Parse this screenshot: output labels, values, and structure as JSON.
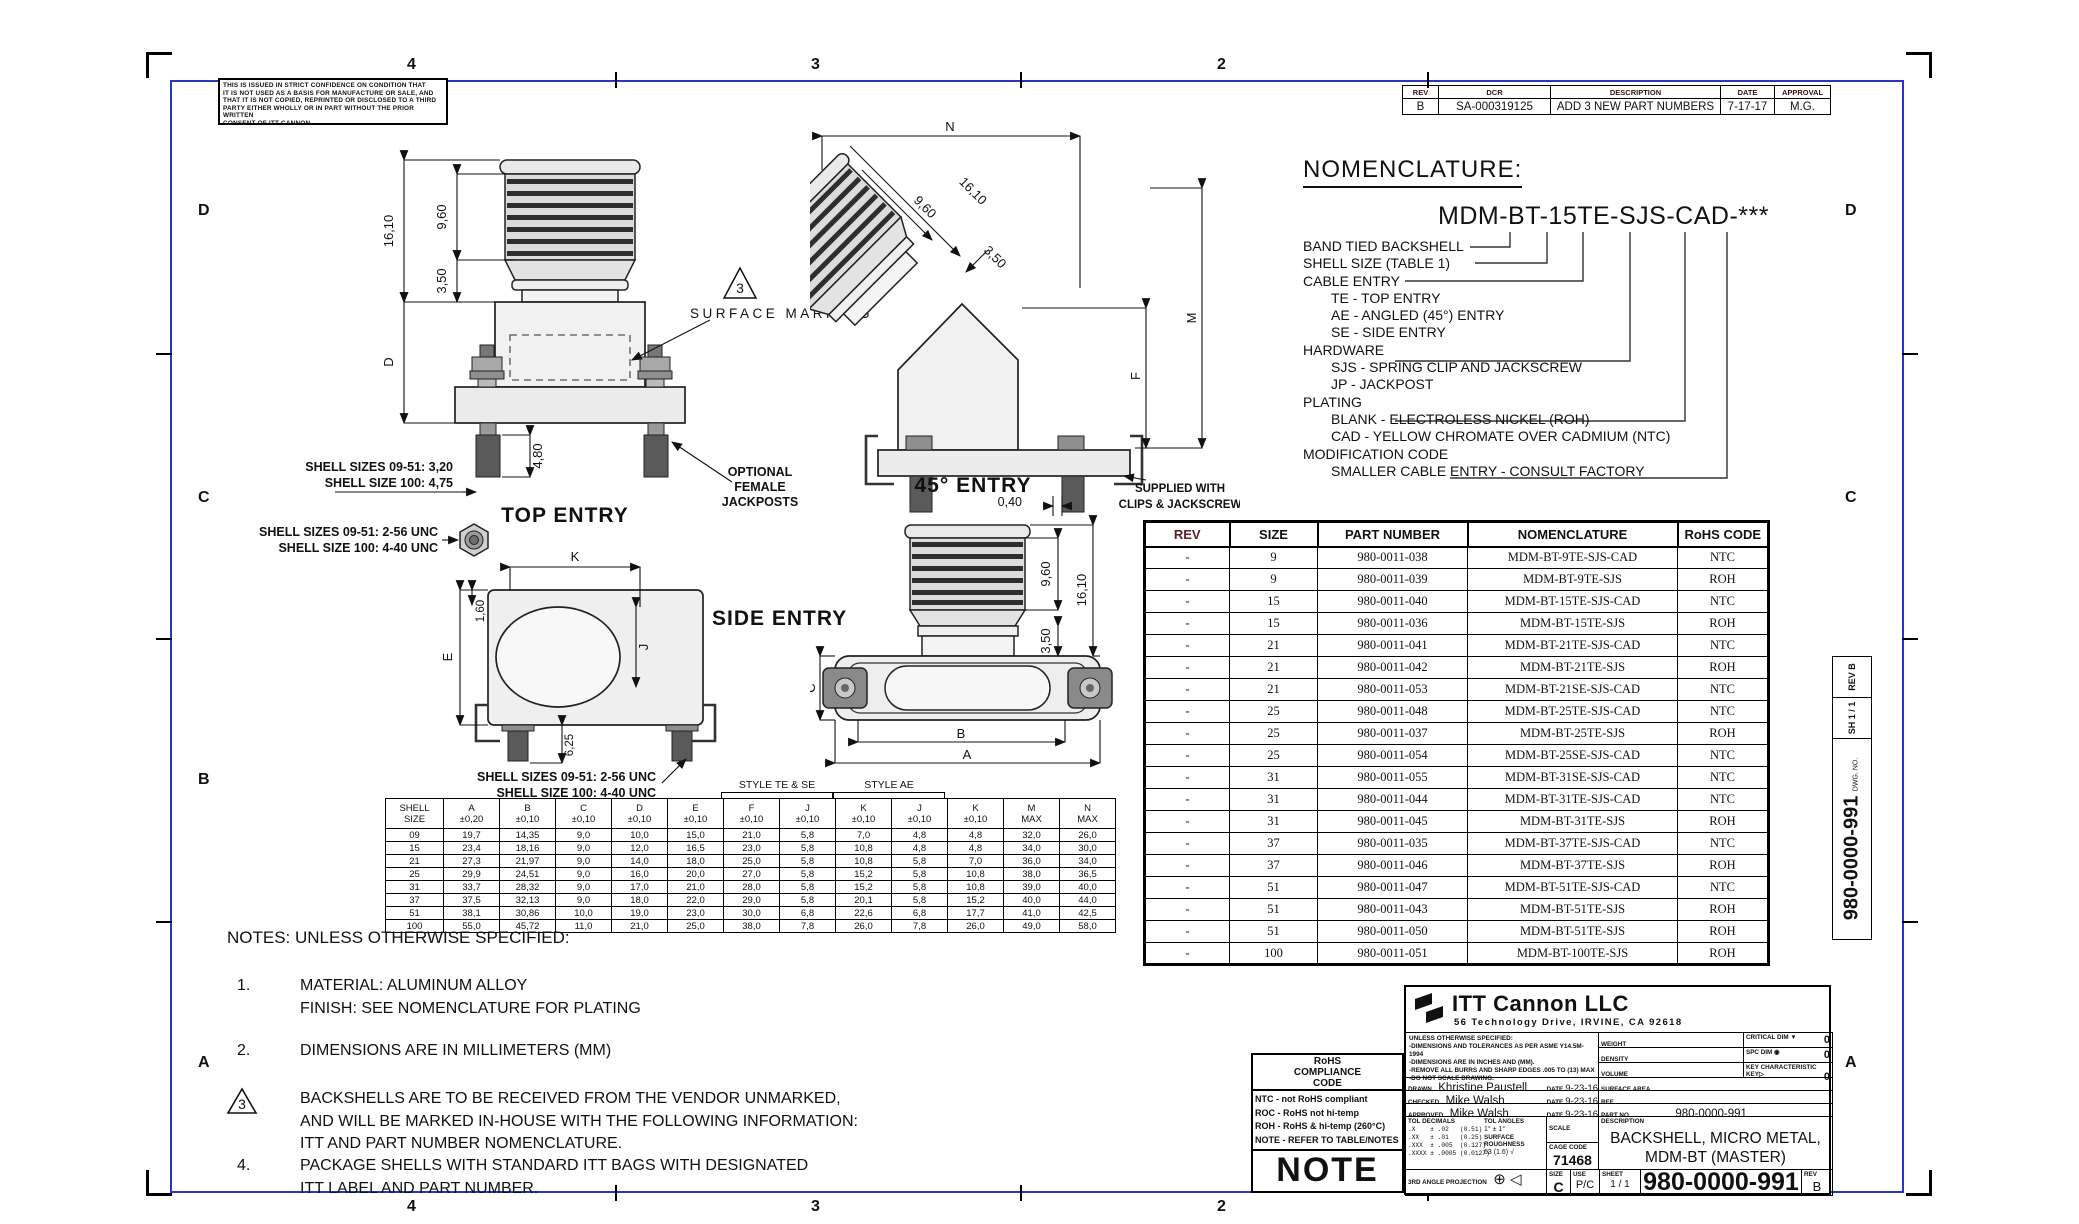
{
  "sheet": {
    "zones_top": [
      "4",
      "3",
      "2"
    ],
    "zones_bottom": [
      "4",
      "3",
      "2"
    ],
    "zones_left": [
      "D",
      "C",
      "B",
      "A"
    ],
    "zones_right": [
      "D",
      "C",
      "A"
    ],
    "confidence_notice": "THIS IS ISSUED IN STRICT CONFIDENCE ON CONDITION THAT\nIT IS NOT USED AS A BASIS FOR MANUFACTURE OR SALE, AND\nTHAT IT IS NOT COPIED, REPRINTED OR DISCLOSED TO A THIRD\nPARTY EITHER WHOLLY OR IN PART WITHOUT THE PRIOR WRITTEN\nCONSENT OF ITT CANNON."
  },
  "revision_table": {
    "headers": [
      "REV",
      "DCR",
      "DESCRIPTION",
      "DATE",
      "APPROVAL"
    ],
    "rows": [
      [
        "B",
        "SA-000319125",
        "ADD 3 NEW PART NUMBERS",
        "7-17-17",
        "M.G."
      ]
    ]
  },
  "nomenclature": {
    "title": "NOMENCLATURE:",
    "part_code": "MDM-BT-15TE-SJS-CAD-***",
    "lines": [
      {
        "indent": 0,
        "text": "BAND TIED BACKSHELL"
      },
      {
        "indent": 0,
        "text": "SHELL SIZE (TABLE 1)"
      },
      {
        "indent": 0,
        "text": "CABLE ENTRY"
      },
      {
        "indent": 1,
        "text": "TE - TOP ENTRY"
      },
      {
        "indent": 1,
        "text": "AE - ANGLED (45°) ENTRY"
      },
      {
        "indent": 1,
        "text": "SE - SIDE ENTRY"
      },
      {
        "indent": 0,
        "text": "HARDWARE"
      },
      {
        "indent": 1,
        "text": "SJS - SPRING CLIP AND JACKSCREW"
      },
      {
        "indent": 1,
        "text": "JP - JACKPOST"
      },
      {
        "indent": 0,
        "text": "PLATING"
      },
      {
        "indent": 1,
        "text": "BLANK - ELECTROLESS NICKEL (ROH)"
      },
      {
        "indent": 1,
        "text": "CAD - YELLOW CHROMATE OVER CADMIUM (NTC)"
      },
      {
        "indent": 0,
        "text": "MODIFICATION CODE"
      },
      {
        "indent": 1,
        "text": "SMALLER CABLE ENTRY - CONSULT FACTORY"
      }
    ]
  },
  "parts_table": {
    "headers": [
      "REV",
      "SIZE",
      "PART NUMBER",
      "NOMENCLATURE",
      "RoHS CODE"
    ],
    "rows": [
      [
        "-",
        "9",
        "980-0011-038",
        "MDM-BT-9TE-SJS-CAD",
        "NTC"
      ],
      [
        "-",
        "9",
        "980-0011-039",
        "MDM-BT-9TE-SJS",
        "ROH"
      ],
      [
        "-",
        "15",
        "980-0011-040",
        "MDM-BT-15TE-SJS-CAD",
        "NTC"
      ],
      [
        "-",
        "15",
        "980-0011-036",
        "MDM-BT-15TE-SJS",
        "ROH"
      ],
      [
        "-",
        "21",
        "980-0011-041",
        "MDM-BT-21TE-SJS-CAD",
        "NTC"
      ],
      [
        "-",
        "21",
        "980-0011-042",
        "MDM-BT-21TE-SJS",
        "ROH"
      ],
      [
        "-",
        "21",
        "980-0011-053",
        "MDM-BT-21SE-SJS-CAD",
        "NTC"
      ],
      [
        "-",
        "25",
        "980-0011-048",
        "MDM-BT-25TE-SJS-CAD",
        "NTC"
      ],
      [
        "-",
        "25",
        "980-0011-037",
        "MDM-BT-25TE-SJS",
        "ROH"
      ],
      [
        "-",
        "25",
        "980-0011-054",
        "MDM-BT-25SE-SJS-CAD",
        "NTC"
      ],
      [
        "-",
        "31",
        "980-0011-055",
        "MDM-BT-31SE-SJS-CAD",
        "NTC"
      ],
      [
        "-",
        "31",
        "980-0011-044",
        "MDM-BT-31TE-SJS-CAD",
        "NTC"
      ],
      [
        "-",
        "31",
        "980-0011-045",
        "MDM-BT-31TE-SJS",
        "ROH"
      ],
      [
        "-",
        "37",
        "980-0011-035",
        "MDM-BT-37TE-SJS-CAD",
        "NTC"
      ],
      [
        "-",
        "37",
        "980-0011-046",
        "MDM-BT-37TE-SJS",
        "ROH"
      ],
      [
        "-",
        "51",
        "980-0011-047",
        "MDM-BT-51TE-SJS-CAD",
        "NTC"
      ],
      [
        "-",
        "51",
        "980-0011-043",
        "MDM-BT-51TE-SJS",
        "ROH"
      ],
      [
        "-",
        "51",
        "980-0011-050",
        "MDM-BT-51TE-SJS",
        "ROH"
      ],
      [
        "-",
        "100",
        "980-0011-051",
        "MDM-BT-100TE-SJS",
        "ROH"
      ]
    ]
  },
  "dim_table": {
    "group_headers": [
      "STYLE TE & SE",
      "STYLE AE"
    ],
    "columns": [
      {
        "label": "SHELL",
        "sub": "SIZE"
      },
      {
        "label": "A",
        "sub": "±0,20"
      },
      {
        "label": "B",
        "sub": "±0,10"
      },
      {
        "label": "C",
        "sub": "±0,10"
      },
      {
        "label": "D",
        "sub": "±0,10"
      },
      {
        "label": "E",
        "sub": "±0,10"
      },
      {
        "label": "F",
        "sub": "±0,10"
      },
      {
        "label": "J",
        "sub": "±0,10"
      },
      {
        "label": "K",
        "sub": "±0,10"
      },
      {
        "label": "J",
        "sub": "±0,10"
      },
      {
        "label": "K",
        "sub": "±0,10"
      },
      {
        "label": "M",
        "sub": "MAX"
      },
      {
        "label": "N",
        "sub": "MAX"
      }
    ],
    "rows": [
      [
        "09",
        "19,7",
        "14,35",
        "9,0",
        "10,0",
        "15,0",
        "21,0",
        "5,8",
        "7,0",
        "4,8",
        "4,8",
        "32,0",
        "26,0"
      ],
      [
        "15",
        "23,4",
        "18,16",
        "9,0",
        "12,0",
        "16,5",
        "23,0",
        "5,8",
        "10,8",
        "4,8",
        "4,8",
        "34,0",
        "30,0"
      ],
      [
        "21",
        "27,3",
        "21,97",
        "9,0",
        "14,0",
        "18,0",
        "25,0",
        "5,8",
        "10,8",
        "5,8",
        "7,0",
        "36,0",
        "34,0"
      ],
      [
        "25",
        "29,9",
        "24,51",
        "9,0",
        "16,0",
        "20,0",
        "27,0",
        "5,8",
        "15,2",
        "5,8",
        "10,8",
        "38,0",
        "36,5"
      ],
      [
        "31",
        "33,7",
        "28,32",
        "9,0",
        "17,0",
        "21,0",
        "28,0",
        "5,8",
        "15,2",
        "5,8",
        "10,8",
        "39,0",
        "40,0"
      ],
      [
        "37",
        "37,5",
        "32,13",
        "9,0",
        "18,0",
        "22,0",
        "29,0",
        "5,8",
        "20,1",
        "5,8",
        "15,2",
        "40,0",
        "44,0"
      ],
      [
        "51",
        "38,1",
        "30,86",
        "10,0",
        "19,0",
        "23,0",
        "30,0",
        "6,8",
        "22,6",
        "6,8",
        "17,7",
        "41,0",
        "42,5"
      ],
      [
        "100",
        "55,0",
        "45,72",
        "11,0",
        "21,0",
        "25,0",
        "38,0",
        "7,8",
        "26,0",
        "7,8",
        "26,0",
        "49,0",
        "58,0"
      ]
    ]
  },
  "notes": {
    "heading": "NOTES: UNLESS OTHERWISE SPECIFIED:",
    "items": [
      {
        "num": "1.",
        "lines": [
          "MATERIAL: ALUMINUM ALLOY",
          "FINISH: SEE NOMENCLATURE FOR PLATING"
        ]
      },
      {
        "num": "2.",
        "lines": [
          "DIMENSIONS ARE IN MILLIMETERS (MM)"
        ]
      },
      {
        "num": "3.",
        "flag_num": "3",
        "lines": [
          "BACKSHELLS ARE TO BE RECEIVED FROM THE VENDOR UNMARKED,",
          "AND WILL BE MARKED IN-HOUSE WITH THE FOLLOWING INFORMATION:",
          "ITT AND PART NUMBER NOMENCLATURE."
        ]
      },
      {
        "num": "4.",
        "lines": [
          "PACKAGE SHELLS WITH STANDARD ITT BAGS WITH DESIGNATED",
          "ITT LABEL AND PART NUMBER."
        ]
      }
    ]
  },
  "views": {
    "top_entry": {
      "label": "TOP ENTRY",
      "dim_overall": "16,10",
      "dim_ribs": "9,60",
      "dim_neck": "3,50",
      "dim_body": "D",
      "dim_stud": "4,80",
      "flag": "3",
      "surface_marking": "SURFACE MARKING",
      "jackposts_note_1": "OPTIONAL",
      "jackposts_note_2": "FEMALE",
      "jackposts_note_3": "JACKPOSTS",
      "stud_note_1": "SHELL SIZES 09-51: 3,20",
      "stud_note_2": "SHELL SIZE 100: 4,75",
      "thread_note_1": "SHELL SIZES 09-51: 2-56 UNC",
      "thread_note_2": "SHELL SIZE 100: 4-40 UNC"
    },
    "entry_45": {
      "label": "45° ENTRY",
      "dim_n": "N",
      "dim_ribs": "9,60",
      "dim_overall": "16,10",
      "dim_neck": "3,50",
      "dim_m": "M",
      "dim_f": "F",
      "clip_note_1": "SUPPLIED WITH",
      "clip_note_2": "CLIPS & JACKSCREW"
    },
    "side_entry": {
      "label": "SIDE ENTRY",
      "dim_k": "K",
      "dim_j": "J",
      "dim_e": "E",
      "dim_lip": "1,60",
      "dim_depth": "6,25",
      "thread_note_1": "SHELL SIZES 09-51: 2-56 UNC",
      "thread_note_2": "SHELL SIZE 100: 4-40 UNC"
    },
    "style_view": {
      "dim_gap": "0,40",
      "dim_ribs": "9,60",
      "dim_overall": "16,10",
      "dim_neck": "3,50",
      "dim_c": "C",
      "dim_b": "B",
      "dim_a": "A"
    }
  },
  "rohs_box": {
    "title": "RoHS\nCOMPLIANCE\nCODE",
    "legend": [
      "NTC - not RoHS compliant",
      "ROC - RoHS not hi-temp",
      "ROH - RoHS & hi-temp (260°C)",
      "NOTE - REFER TO TABLE/NOTES"
    ],
    "big_label": "NOTE"
  },
  "title_block": {
    "company": "ITT Cannon LLC",
    "address": "56 Technology Drive, IRVINE, CA 92618",
    "specs": "UNLESS OTHERWISE SPECIFIED:\n-DIMENSIONS AND TOLERANCES AS PER ASME Y14.5M-1994\n-DIMENSIONS ARE IN INCHES AND (MM).\n-REMOVE ALL BURRS AND SHARP EDGES .005 TO (13) MAX\n-DO NOT SCALE DRAWING.",
    "weight_label": "WEIGHT",
    "density_label": "DENSITY",
    "volume_label": "VOLUME",
    "surface_area_label": "SURFACE AREA",
    "ref_label": "REF",
    "quality": [
      {
        "label": "CRITICAL DIM",
        "symbol": "▼",
        "value": "0"
      },
      {
        "label": "SPC DIM",
        "symbol": "◉",
        "value": "0"
      },
      {
        "label": "KEY CHARACTERISTIC",
        "symbol": "KEY▷",
        "value": "0"
      }
    ],
    "drawn_label": "DRAWN",
    "drawn": "Khristine Paustell",
    "checked_label": "CHECKED",
    "checked": "Mike Walsh",
    "approved_label": "APPROVED",
    "approved": "Mike Walsh",
    "date_label": "DATE",
    "drawn_date": "9-23-16",
    "checked_date": "9-23-16",
    "approved_date": "9-23-16",
    "part_no_label": "PART NO",
    "part_no": "980-0000-991",
    "tol_title": "TOL DECIMALS",
    "tol_lines": ".X    ± .02   (0.51)\n.XX   ± .01   (0.25)\n.XXX  ± .005  (0.127)\n.XXXX ± .0005 (0.0127)",
    "tol_angles_title": "TOL ANGLES",
    "tol_angles": "1° ± 1°",
    "surface_roughness_label": "SURFACE ROUGHNESS",
    "surface_roughness": "63 (1.6) √",
    "scale_label": "SCALE",
    "cage_label": "CAGE CODE",
    "cage_code": "71468",
    "description_label": "DESCRIPTION",
    "description": "BACKSHELL, MICRO METAL, MDM-BT (MASTER)",
    "projection_label": "3RD ANGLE PROJECTION",
    "projection_symbols": "⊕ ◁",
    "size_label": "SIZE",
    "size": "C",
    "use_label": "USE",
    "use": "P/C",
    "sheet_label": "SHEET",
    "sheet": "1 / 1",
    "drawing_number": "980-0000-991",
    "rev_label": "REV",
    "rev": "B"
  },
  "edge_strip": {
    "rev": "REV  B",
    "sh": "SH  1 / 1",
    "dwg_label": "DWG. NO.",
    "dwg_no": "980-0000-991"
  }
}
